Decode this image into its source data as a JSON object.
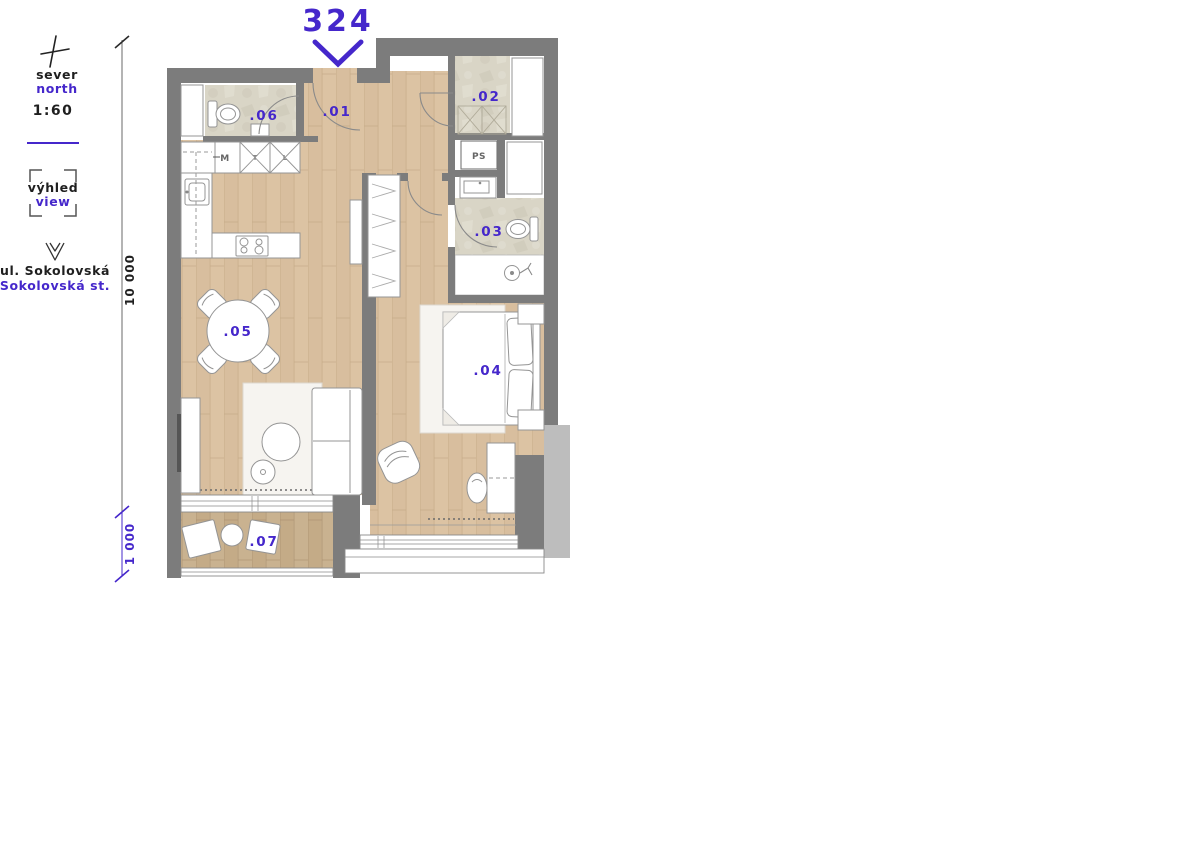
{
  "title": "324",
  "legend": {
    "north_cs": "sever",
    "north_en": "north",
    "scale": "1:60",
    "view_cs": "výhled",
    "view_en": "view",
    "street_cs": "ul. Sokolovská",
    "street_en": "Sokolovská st."
  },
  "dimensions": {
    "total_height": "10 000",
    "balcony_depth": "1 000"
  },
  "rooms": [
    {
      "label": ".01"
    },
    {
      "label": ".02"
    },
    {
      "label": ".03"
    },
    {
      "label": ".04"
    },
    {
      "label": ".05"
    },
    {
      "label": ".06"
    },
    {
      "label": ".07"
    }
  ],
  "labels": {
    "shaft": "PS",
    "appliance_m": "M",
    "appliance_t": "T",
    "appliance_l": "L"
  },
  "colors": {
    "accent": "#4527cb",
    "wall": "#7c7c7c",
    "wood": "#dcc3a3",
    "wood_balcony": "#c9b290",
    "stone": "#d9d5c6"
  }
}
